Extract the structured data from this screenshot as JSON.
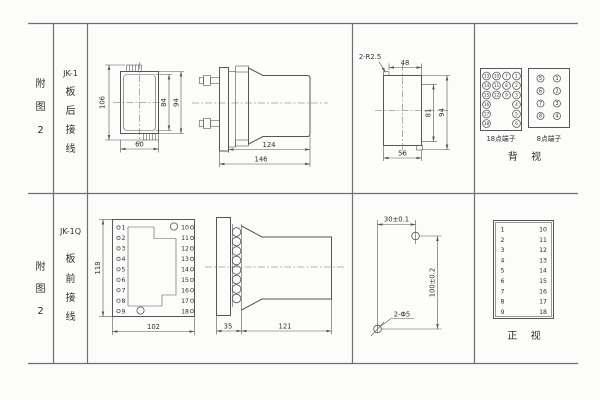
{
  "colors": {
    "bg": "#fcfcfb",
    "line": "#565656",
    "text": "#2f2f2f"
  },
  "row1": {
    "fig": {
      "c1": "附",
      "c2": "图",
      "c3": "2"
    },
    "model": "JK-1",
    "wiring": {
      "c1": "板",
      "c2": "后",
      "c3": "接",
      "c4": "线"
    },
    "front": {
      "h": "106",
      "inner_h": "84",
      "outer_h": "94",
      "w": "60"
    },
    "side": {
      "body": "124",
      "total": "146"
    },
    "cutout": {
      "corner": "2-R2.5",
      "top": "48",
      "inner_h": "81",
      "outer_h": "94",
      "bottom": "56"
    },
    "back": {
      "b18": {
        "label": "18点端子",
        "outer_left": [
          "13",
          "14",
          "15",
          "16",
          "17",
          "18"
        ],
        "inner_left": [
          "10",
          "11",
          "12"
        ],
        "inner_right": [
          "7",
          "8",
          "9"
        ],
        "outer_right": [
          "1",
          "2",
          "3",
          "4",
          "5",
          "6"
        ]
      },
      "b8": {
        "label": "8点端子",
        "left": [
          "5",
          "6",
          "7",
          "8"
        ],
        "right": [
          "1",
          "2",
          "3",
          "4"
        ]
      },
      "view": "背 视"
    }
  },
  "row2": {
    "fig": {
      "c1": "附",
      "c2": "图",
      "c3": "2"
    },
    "model": "JK-1Q",
    "wiring": {
      "c1": "板",
      "c2": "前",
      "c3": "接",
      "c4": "线"
    },
    "front": {
      "h": "118",
      "w": "102",
      "left": [
        "1",
        "2",
        "3",
        "4",
        "5",
        "6",
        "7",
        "8",
        "9"
      ],
      "right": [
        "10",
        "11",
        "12",
        "13",
        "14",
        "15",
        "16",
        "17",
        "18"
      ]
    },
    "side": {
      "plate": "35",
      "body": "121"
    },
    "mount": {
      "h": "30±0.1",
      "v": "100±0.2",
      "holes": "2-Φ5"
    },
    "ftable": {
      "left": [
        "1",
        "2",
        "3",
        "4",
        "5",
        "6",
        "7",
        "8",
        "9"
      ],
      "right": [
        "10",
        "11",
        "12",
        "13",
        "14",
        "15",
        "16",
        "17",
        "18"
      ],
      "view": "正 视"
    }
  }
}
